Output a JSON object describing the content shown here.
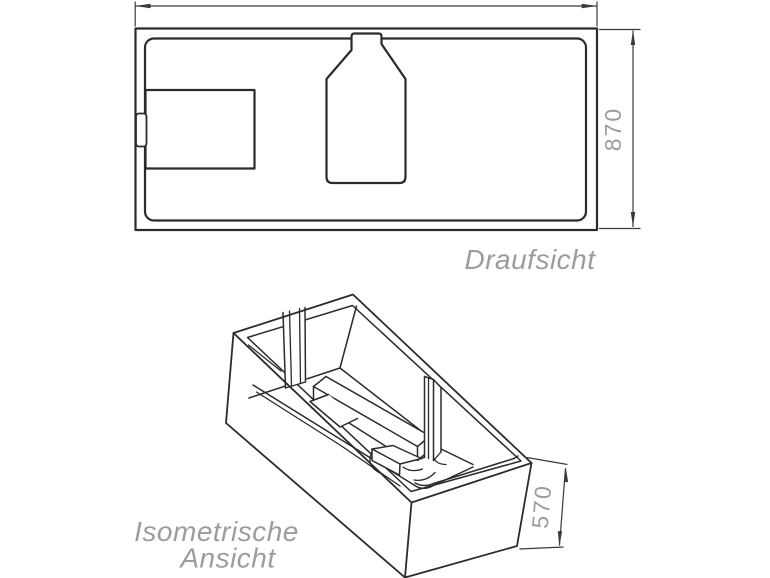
{
  "colors": {
    "background": "#ffffff",
    "line": "#2b2b2b",
    "dim_line": "#3a3a3a",
    "label_text": "#9c9c9c",
    "dim_text": "#9c9c9c"
  },
  "top_view": {
    "label": "Draufsicht",
    "height_dim": "870"
  },
  "isometric_view": {
    "label_line1": "Isometrische",
    "label_line2": "Ansicht",
    "height_dim": "570"
  }
}
